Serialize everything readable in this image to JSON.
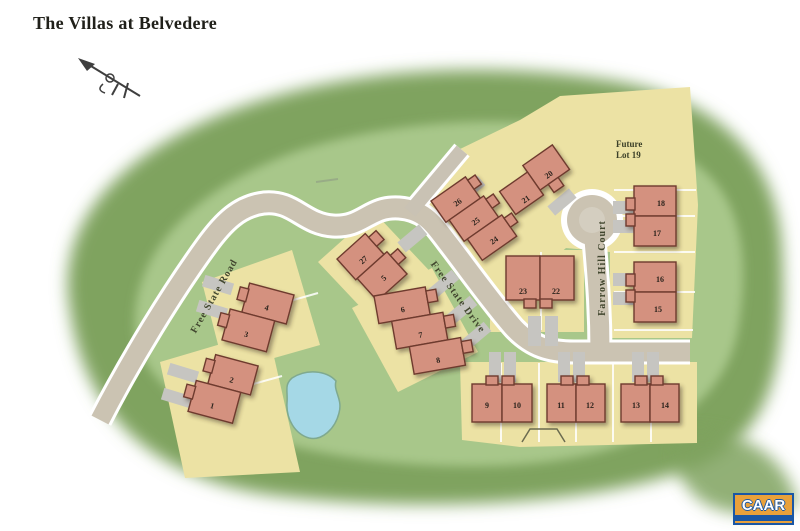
{
  "page": {
    "title": "The Villas at Belvedere"
  },
  "map": {
    "roads": {
      "free_state_road": "Free State Road",
      "free_state_drive": "Free State Drive",
      "farrow_hill_court": "Farrow Hill Court"
    },
    "future_lot": {
      "line1": "Future",
      "line2": "Lot 19"
    },
    "lot_numbers": {
      "lot1": "1",
      "lot2": "2",
      "lot3": "3",
      "lot4": "4",
      "lot5": "5",
      "lot6": "6",
      "lot7": "7",
      "lot8": "8",
      "lot9": "9",
      "lot10": "10",
      "lot11": "11",
      "lot12": "12",
      "lot13": "13",
      "lot14": "14",
      "lot15": "15",
      "lot16": "16",
      "lot17": "17",
      "lot18": "18",
      "lot20": "20",
      "lot21": "21",
      "lot22": "22",
      "lot23": "23",
      "lot24": "24",
      "lot25": "25",
      "lot26": "26",
      "lot27": "27"
    }
  },
  "logo": {
    "text": "CAAR"
  },
  "colors": {
    "forest": "#7fa35f",
    "field": "#a8c78a",
    "parcel": "#ece2a4",
    "road": "#cbc3b2",
    "driveway": "#c6c5c1",
    "building": "#d4917f",
    "building_outline": "#6e3a2e",
    "pond": "#a5d8e6",
    "logo_blue": "#1a57a5",
    "logo_orange": "#e9a13b"
  }
}
